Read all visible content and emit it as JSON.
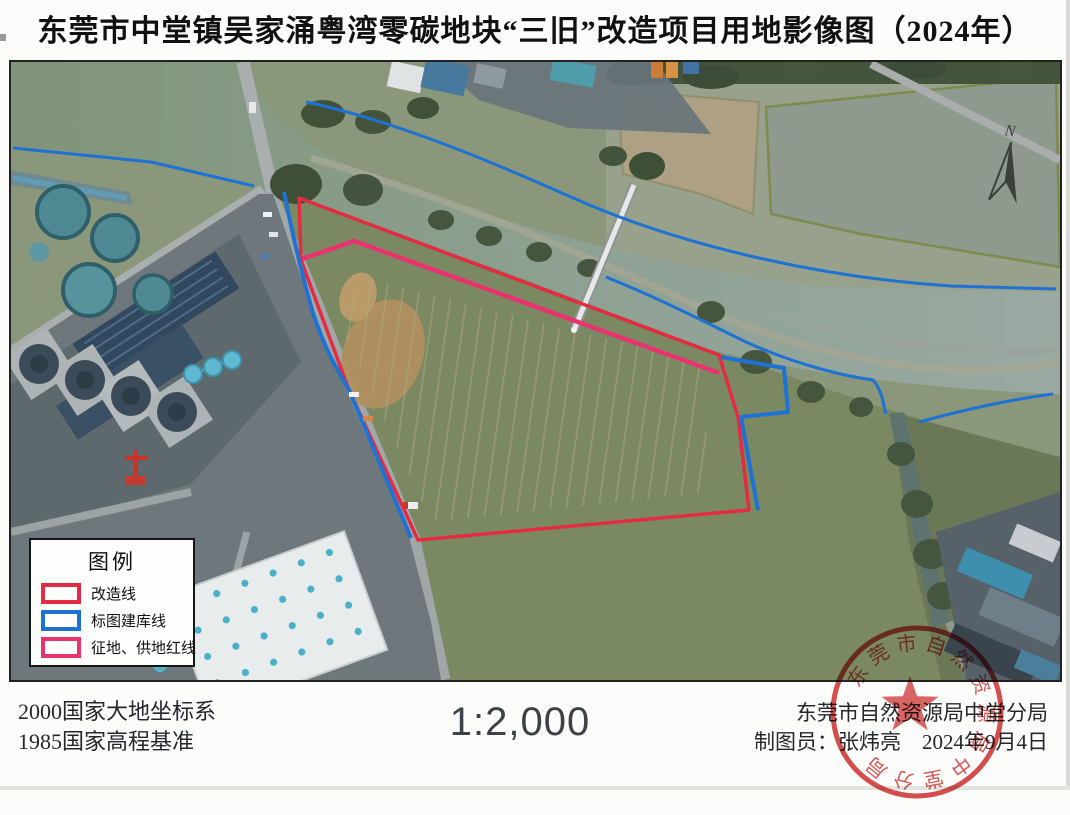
{
  "title": "东莞市中堂镇吴家涌粤湾零碳地块“三旧”改造项目用地影像图（2024年）",
  "legend": {
    "title": "图例",
    "items": [
      {
        "label": "改造线"
      },
      {
        "label": "标图建库线"
      },
      {
        "label": "征地、供地红线"
      }
    ]
  },
  "map": {
    "north_label": "N"
  },
  "footer": {
    "datum_line1": "2000国家大地坐标系",
    "datum_line2": "1985国家高程基准",
    "scale": "1:2,000",
    "agency": "东莞市自然资源局中堂分局",
    "cartographer_line": "制图员：张炜亮　2024年9月4日"
  },
  "seal": {
    "ring_text": "东莞市自然资源局中堂分局"
  },
  "colors": {
    "redline": "#e32b41",
    "blueline": "#1e72d4",
    "magline": "#e9336f",
    "seal": "#d44040",
    "ink": "#1c1c1c"
  }
}
